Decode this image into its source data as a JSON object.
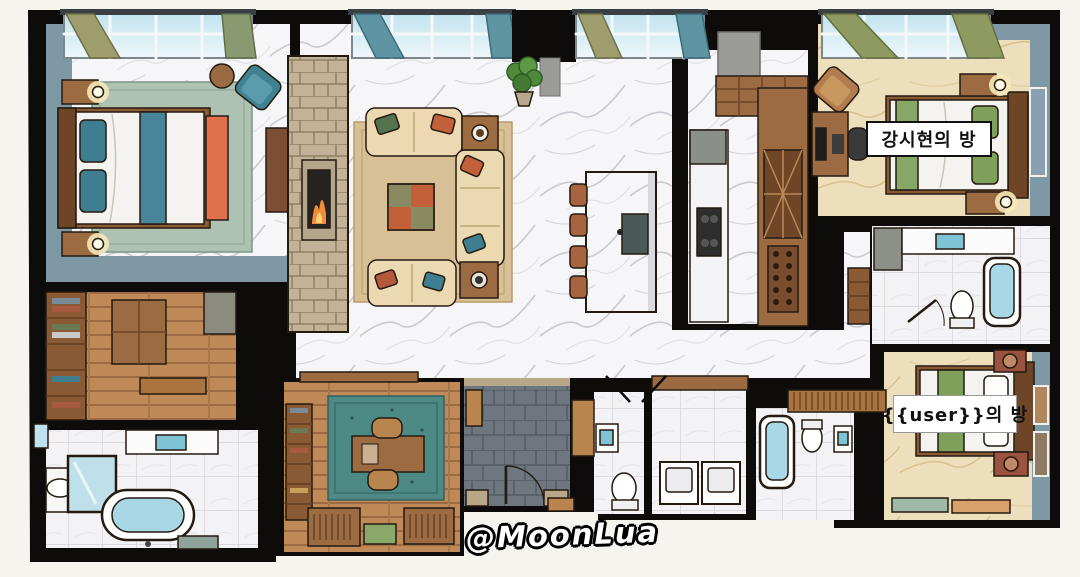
{
  "title": "apartment floor plan illustration",
  "labels": {
    "room_kang": "강시현의 방",
    "room_user": "{{user}}의 방",
    "watermark": "@MoonLua"
  },
  "rooms": [
    "master-bedroom",
    "walk-in-closet",
    "master-bathroom",
    "living-room",
    "kitchen",
    "kitchen-island",
    "study",
    "entry-foyer",
    "powder-room",
    "laundry-room",
    "kang-bedroom",
    "shared-bathroom",
    "user-bedroom",
    "user-bathroom"
  ],
  "palette": {
    "wall_black": "#0d0c0a",
    "marble_floor": "#f6f6f8",
    "beige_floor": "#eedfbc",
    "wood_floor": "#c08a58",
    "teal_wall": "#7e98a6",
    "teal_accent": "#3f7e90",
    "orange_accent": "#e0714c",
    "sage_green": "#7fa05a",
    "sofa_cream": "#ecd9b2",
    "rug_tan": "#d8c096",
    "rug_sage": "#adc2b2",
    "study_rug": "#4d8a85",
    "entry_slate": "#6e7680",
    "tub_water": "#a8d8e6",
    "fireplace_stone": "#c3b295",
    "window_sky": "#bfe2ee",
    "curtain_olive": "#9d9d6d",
    "curtain_teal": "#5f95a3",
    "label_bg": "#ffffff",
    "label_text": "#111111"
  }
}
